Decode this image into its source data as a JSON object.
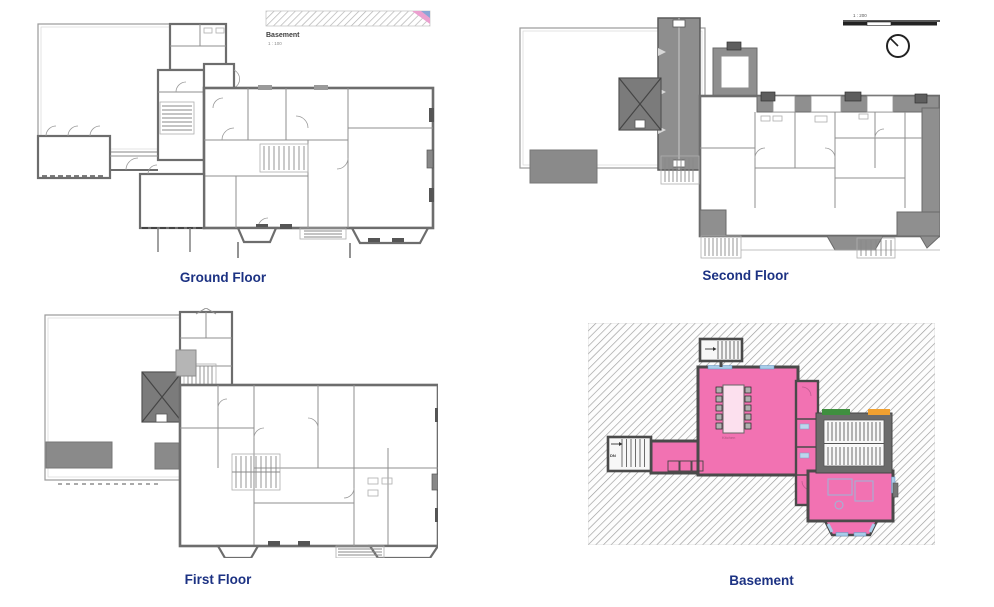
{
  "page": {
    "background": "#ffffff",
    "type": "floorplan-sheet"
  },
  "plans": [
    {
      "id": "ground-floor",
      "caption": "Ground Floor"
    },
    {
      "id": "second-floor",
      "caption": "Second Floor",
      "scale_label": "1 : 200"
    },
    {
      "id": "first-floor",
      "caption": "First Floor"
    },
    {
      "id": "basement",
      "caption": "Basement",
      "room_label": "Kitchen",
      "stair_label": "DN"
    }
  ],
  "legend": {
    "title": "Basement",
    "scale": "1 : 100"
  },
  "icons": {
    "compass": "north-arrow"
  },
  "colors": {
    "caption_blue": "#1c3283",
    "wall_gray": "#6d6d6d",
    "roof_gray": "#7b7b7b",
    "tower_gray": "#8e8e8e",
    "basement_pink": "#F272B2",
    "window_blue": "#a8cce8",
    "accent_orange": "#f0a030",
    "accent_green": "#3f8f3f",
    "hatch_gray": "#9c9c9c"
  }
}
